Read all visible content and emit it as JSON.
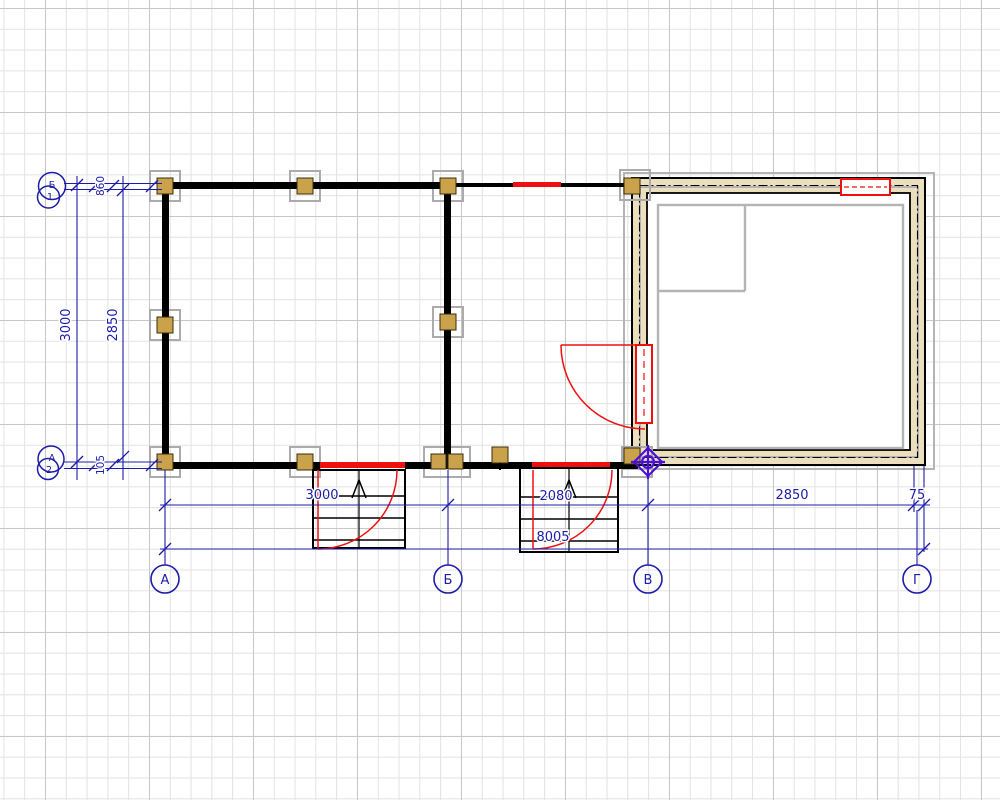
{
  "drawing": {
    "type": "architectural-floor-plan",
    "axes_bottom": [
      "А",
      "Б",
      "В",
      "Г"
    ],
    "axes_left": {
      "top_pair": {
        "letter": "Б",
        "number": "1"
      },
      "bottom_pair": {
        "letter": "А",
        "number": "2"
      }
    },
    "dimensions": {
      "left_total": "3000",
      "left_inner": "2850",
      "left_top_small": "860",
      "left_bottom_small": "105",
      "bottom_segments": [
        "3000",
        "2080",
        "2850",
        "75"
      ],
      "bottom_total": "8005"
    },
    "colors": {
      "dimension_blue": "#1c1ca8",
      "opening_red": "#ee1010",
      "wall_black": "#000000",
      "timber_wall_fill": "#ecdfbd",
      "column_fill": "#c9a24b",
      "reference_gray": "#b4b4b4",
      "survey_marker_purple": "#4a10d8",
      "grid_minor": "#e2e2e2",
      "grid_major": "#c7c7c7"
    }
  }
}
